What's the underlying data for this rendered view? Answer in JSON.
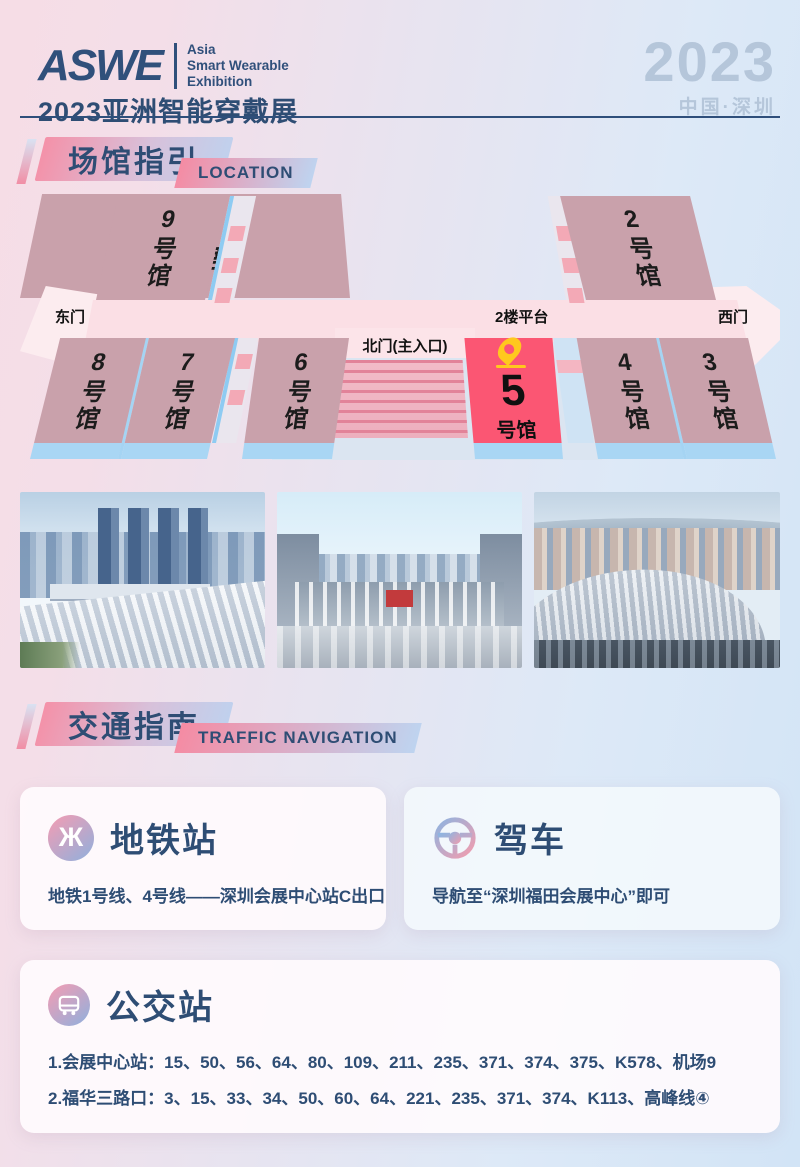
{
  "header": {
    "logo": "ASWE",
    "logo_tagline": [
      "Asia",
      "Smart Wearable",
      "Exhibition"
    ],
    "subtitle": "2023亚洲智能穿戴展",
    "year": "2023",
    "location": "中国·深圳"
  },
  "section_location": {
    "title": "场馆指引",
    "tag": "LOCATION"
  },
  "section_traffic": {
    "title": "交通指南",
    "tag": "TRAFFIC NAVIGATION"
  },
  "map": {
    "hall9": "9号馆",
    "south_gate": "南门",
    "hall1": "1号馆",
    "hall2": "2号馆",
    "east_gate": "东门",
    "platform": "2楼平台",
    "west_gate": "西门",
    "north_gate": "北门(主入口)",
    "hall8": "8号馆",
    "hall7": "7号馆",
    "hall6": "6号馆",
    "hall5_num": "5",
    "hall5_suffix": "号馆",
    "hall4": "4号馆",
    "hall3": "3号馆"
  },
  "traffic": {
    "metro": {
      "title": "地铁站",
      "desc": "地铁1号线、4号线——深圳会展中心站C出口"
    },
    "drive": {
      "title": "驾车",
      "desc": "导航至“深圳福田会展中心”即可"
    },
    "bus": {
      "title": "公交站",
      "lines": [
        "1.会展中心站：15、50、56、64、80、109、211、235、371、374、375、K578、机场9",
        "2.福华三路口：3、15、33、34、50、60、64、221、235、371、374、K113、高峰线④"
      ]
    }
  },
  "colors": {
    "navy": "#2e4d74",
    "hall": "#c9a1ab",
    "hall_highlight": "#fb5673",
    "pin_yellow": "#ffc81e",
    "base_blue": "#a9d6f4",
    "platform_pink": "#fbdfe5"
  }
}
